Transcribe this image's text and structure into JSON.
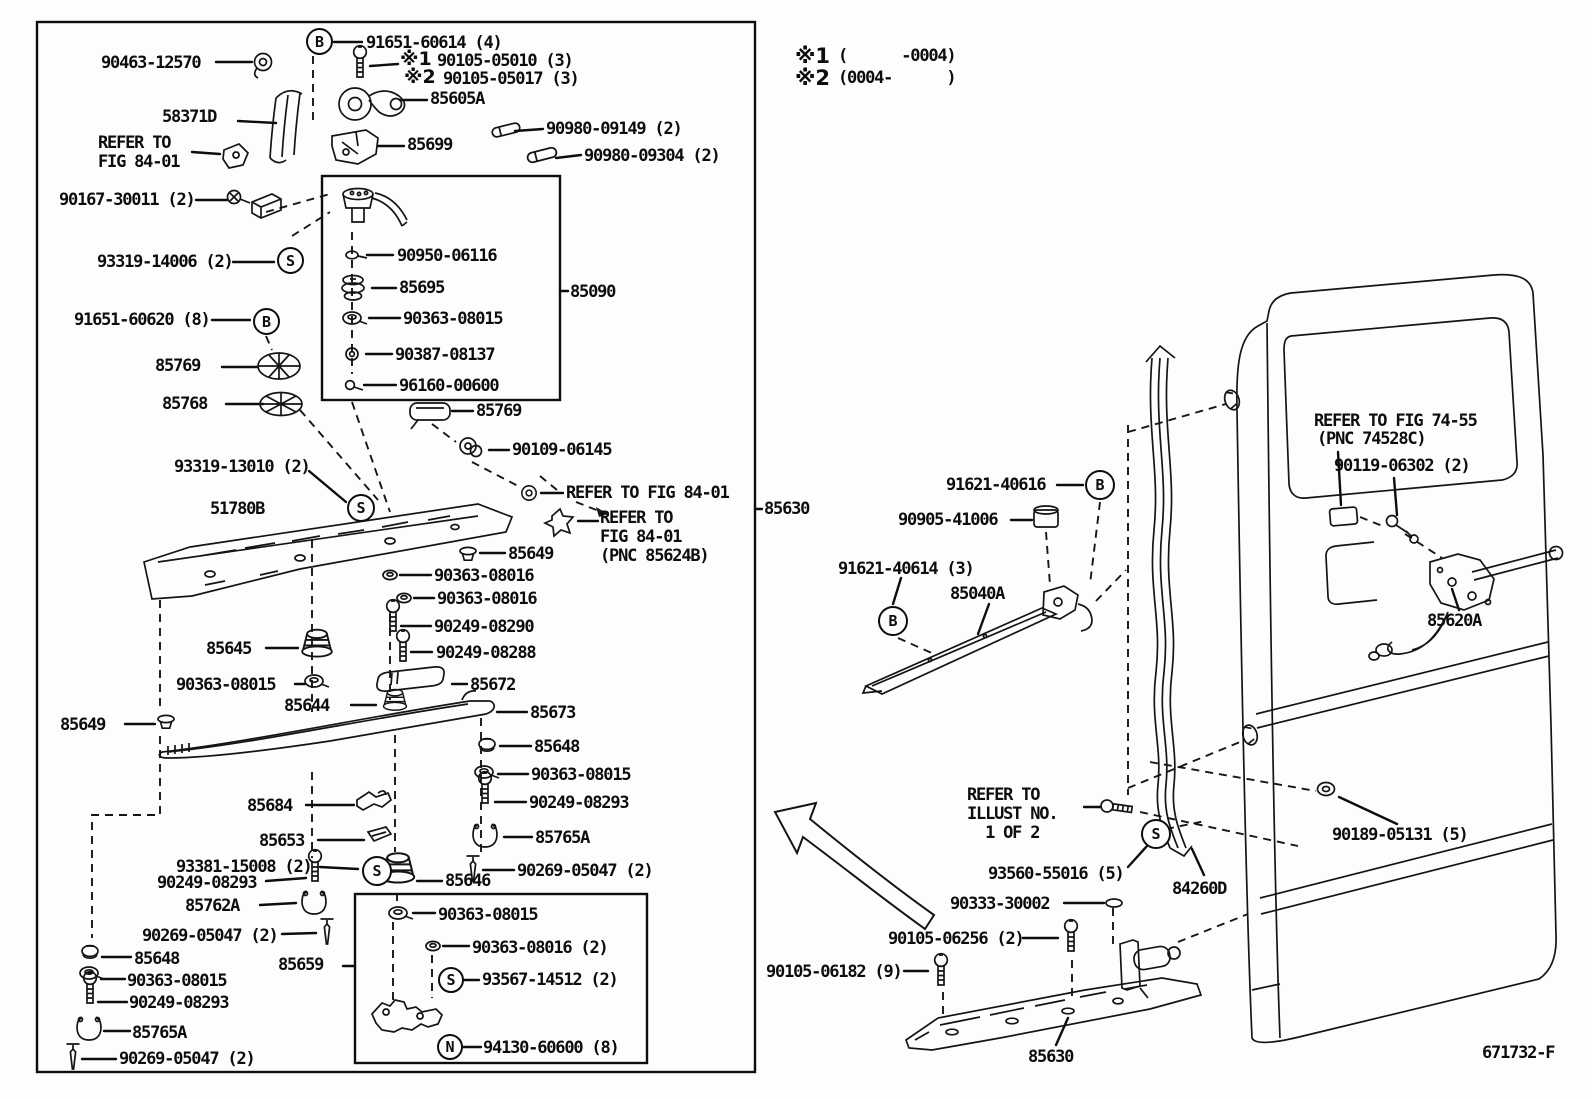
{
  "figure": {
    "code": "671732-F"
  },
  "applicability": {
    "mark1": "※1",
    "range1": "(      -0004)",
    "mark2": "※2",
    "range2": "(0004-      )"
  },
  "shared_marks": {
    "b": "B",
    "s": "S",
    "n": "N"
  },
  "callouts": {
    "c90463_12570": "90463-12570",
    "c91651_60614": "91651-60614 (4)",
    "c90105_05010": "90105-05010 (3)",
    "c90105_05017": "90105-05017 (3)",
    "c58371d": "58371D",
    "ref_fig84_2l": "REFER TO\nFIG 84-01",
    "c85605a": "85605A",
    "c85699": "85699",
    "c90980_09149": "90980-09149 (2)",
    "c90980_09304": "90980-09304 (2)",
    "c90167_30011": "90167-30011 (2)",
    "c93319_14006": "93319-14006 (2)",
    "c91651_60620": "91651-60620 (8)",
    "c85769": "85769",
    "c85768": "85768",
    "c90950_06116": "90950-06116",
    "c85695": "85695",
    "c90363_08015": "90363-08015",
    "c90387_08137": "90387-08137",
    "c96160_00600": "96160-00600",
    "c85090": "85090",
    "c90109_06145": "90109-06145",
    "ref_fig84_1l": "REFER TO FIG 84-01",
    "ref_fig84_pnc": "REFER TO\nFIG 84-01\n(PNC 85624B)",
    "c93319_13010": "93319-13010 (2)",
    "c51780b": "51780B",
    "c85630": "85630",
    "c85649": "85649",
    "c90363_08016": "90363-08016",
    "c90363_08016_q2": "90363-08016 (2)",
    "c90249_08290": "90249-08290",
    "c90249_08288": "90249-08288",
    "c85645": "85645",
    "c85644": "85644",
    "c85672": "85672",
    "c85673": "85673",
    "c85648": "85648",
    "c90249_08293": "90249-08293",
    "c85765a": "85765A",
    "c90269_05047": "90269-05047 (2)",
    "c85684": "85684",
    "c85653": "85653",
    "c93381_15008": "93381-15008 (2)",
    "c85762a": "85762A",
    "c85646": "85646",
    "c85659": "85659",
    "c93567_14512": "93567-14512 (2)",
    "c94130_60600": "94130-60600 (8)",
    "c91621_40616": "91621-40616",
    "c90905_41006": "90905-41006",
    "c91621_40614": "91621-40614 (3)",
    "c85040a": "85040A",
    "ref_fig74_55": "REFER TO FIG 74-55",
    "ref_pnc74528c": "(PNC 74528C)",
    "c90119_06302": "90119-06302 (2)",
    "c85620a": "85620A",
    "ref_illust": "REFER TO\nILLUST NO.\n  1 OF 2",
    "c93560_55016": "93560-55016 (5)",
    "c90333_30002": "90333-30002",
    "c90105_06256": "90105-06256 (2)",
    "c90105_06182": "90105-06182 (9)",
    "c84260d": "84260D",
    "c90189_05131": "90189-05131 (5)"
  }
}
